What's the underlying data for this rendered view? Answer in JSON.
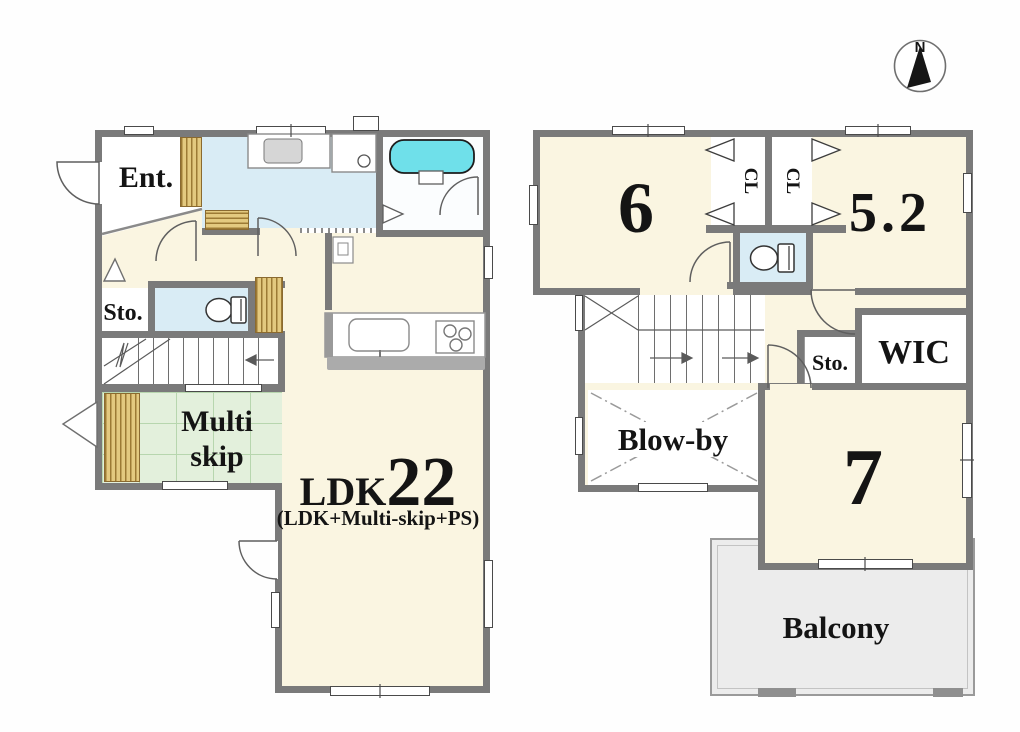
{
  "compass": {
    "north_label": "N"
  },
  "floor1": {
    "entrance_label": "Ent.",
    "storage_label": "Sto.",
    "multi_skip_line1": "Multi",
    "multi_skip_line2": "skip",
    "ldk_prefix": "LDK",
    "ldk_size": "22",
    "ldk_note": "(LDK+Multi-skip+PS)"
  },
  "floor2": {
    "room6_label": "6",
    "closet1_label": "CL",
    "closet2_label": "CL",
    "room52_label": "5.2",
    "wic_label": "WIC",
    "storage_label": "Sto.",
    "blowby_label": "Blow-by",
    "room7_label": "7",
    "balcony_label": "Balcony"
  },
  "colors": {
    "wall": "#7a7a7a",
    "room_cream": "#faf5e1",
    "wet_area_blue": "#d9ecf5",
    "bathtub_cyan": "#6fe0ea",
    "tatami_green": "#e3f0dc",
    "wood_tan": "#e3c97f",
    "balcony_gray": "#ececec"
  }
}
